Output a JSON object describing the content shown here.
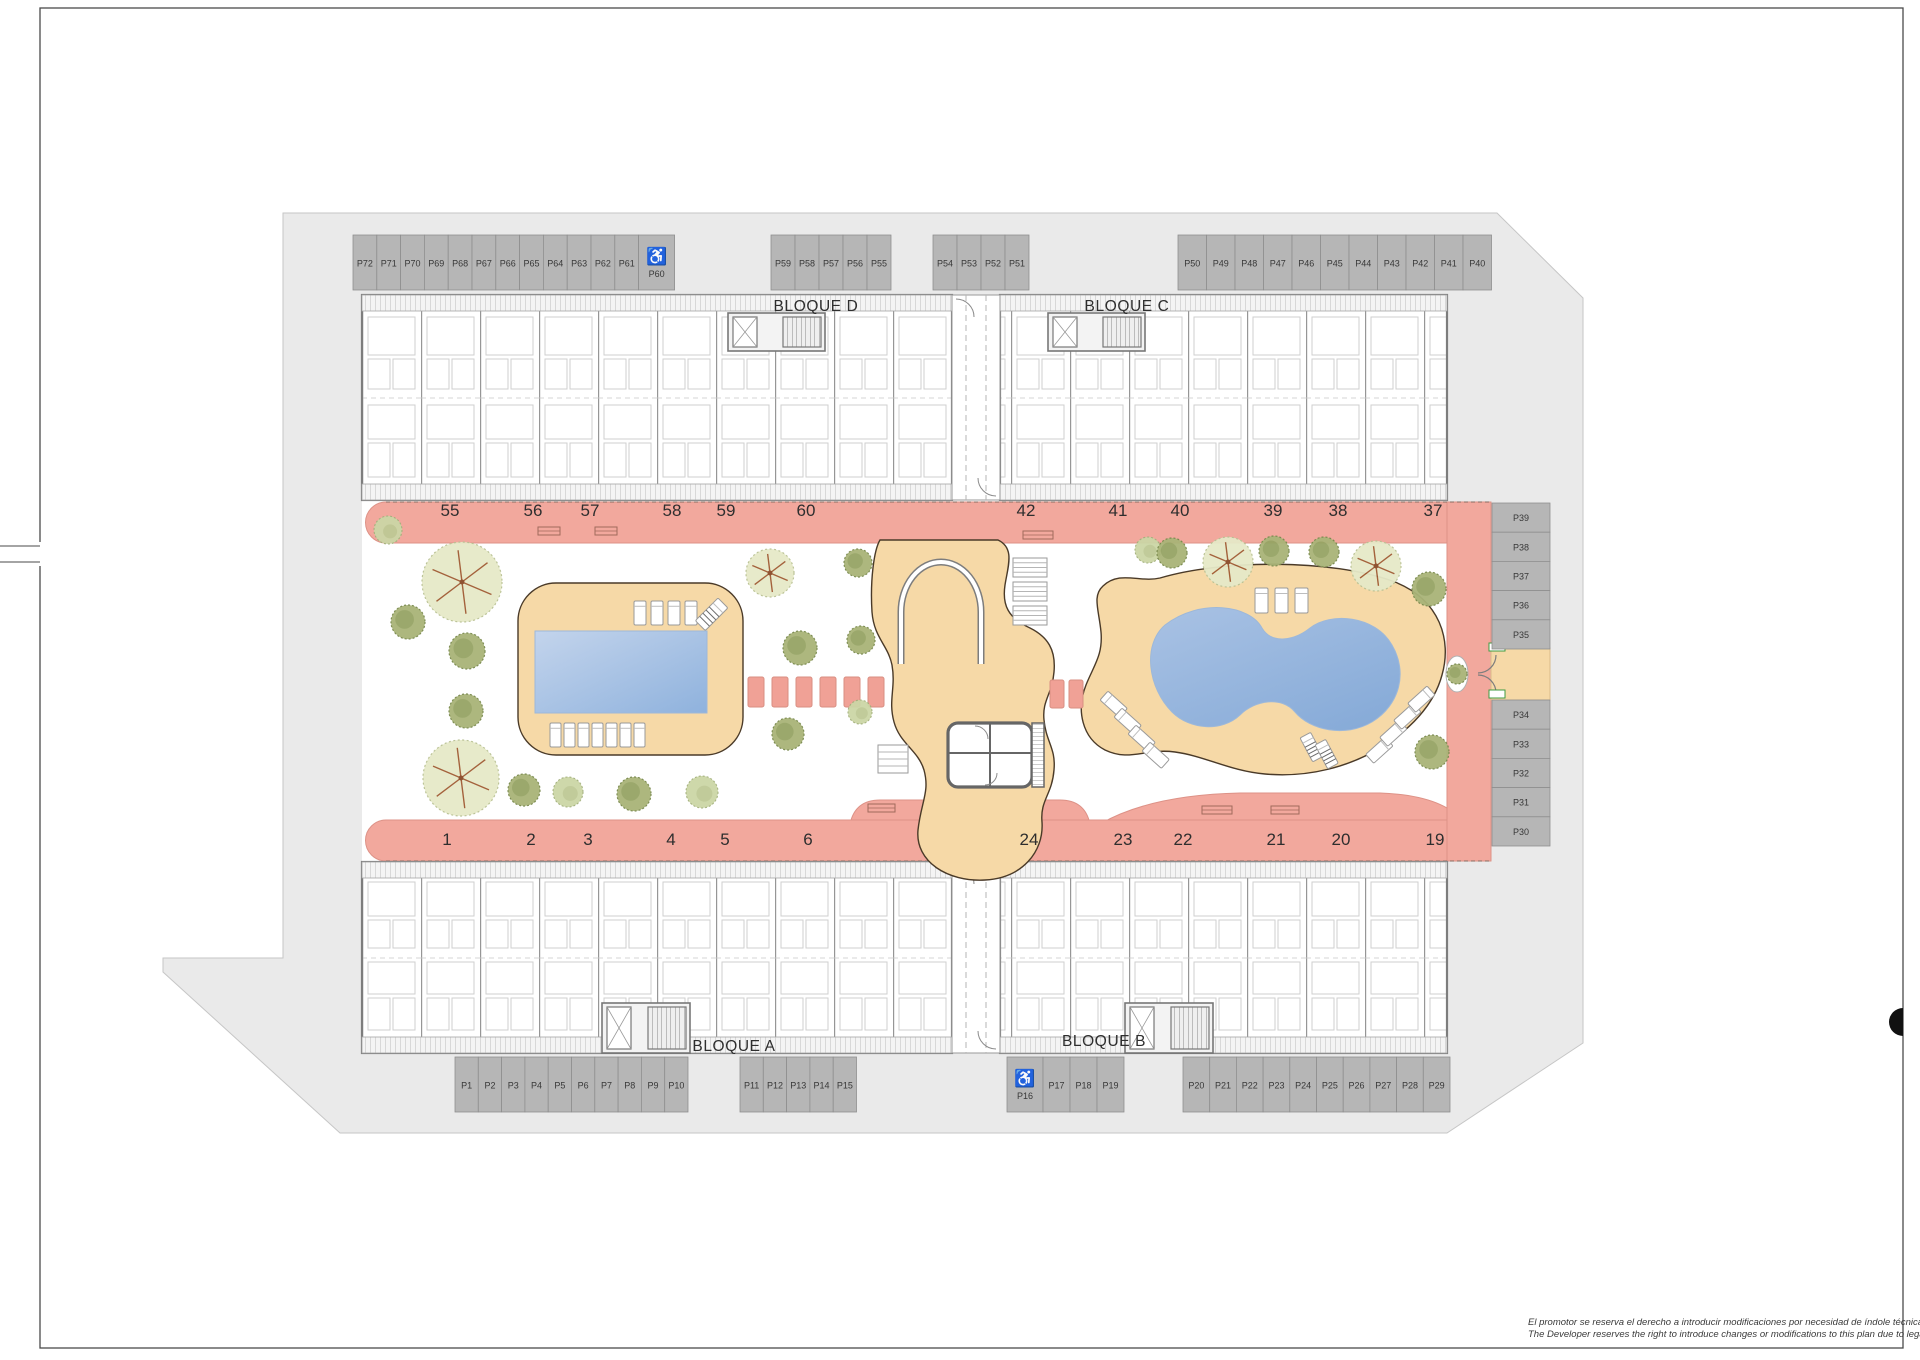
{
  "page": {
    "disclaimer_line1": "El promotor se reserva el derecho a introducir modificaciones por necesidad de índole técnica o legal.",
    "disclaimer_line2": "The Developer reserves the right to introduce changes or modifications to this plan due to legal or tech"
  },
  "colors": {
    "road": "#eaeaea",
    "stall": "#b6b6b6",
    "walkway": "#f2a89d",
    "deck": "#f6d9a7",
    "pool_light": "#bad0ea",
    "pool_dark": "#8fb2dd",
    "wall": "#7d7d7d",
    "accent_green": "#3f9b41"
  },
  "blocks": [
    {
      "label": "BLOQUE D",
      "x": 816,
      "y": 311
    },
    {
      "label": "BLOQUE C",
      "x": 1127,
      "y": 311
    },
    {
      "label": "BLOQUE A",
      "x": 734,
      "y": 1051
    },
    {
      "label": "BLOQUE B",
      "x": 1104,
      "y": 1046
    }
  ],
  "parking": {
    "groups": [
      {
        "name": "north-west",
        "dir": "h",
        "x": 353,
        "y": 235,
        "stall_w": 23.8,
        "stall_h": 55,
        "stalls": [
          "P72",
          "P71",
          "P70",
          "P69",
          "P68",
          "P67",
          "P66",
          "P65",
          "P64",
          "P63",
          "P62",
          "P61",
          {
            "label": "P60",
            "accessible": true,
            "w": 36
          }
        ]
      },
      {
        "name": "north-mid-west",
        "dir": "h",
        "x": 771,
        "y": 235,
        "stall_w": 24,
        "stall_h": 55,
        "stalls": [
          "P59",
          "P58",
          "P57",
          "P56",
          "P55"
        ]
      },
      {
        "name": "north-mid-east",
        "dir": "h",
        "x": 933,
        "y": 235,
        "stall_w": 24,
        "stall_h": 55,
        "stalls": [
          "P54",
          "P53",
          "P52",
          "P51"
        ]
      },
      {
        "name": "north-east",
        "dir": "h",
        "x": 1178,
        "y": 235,
        "stall_w": 28.5,
        "stall_h": 55,
        "stalls": [
          "P50",
          "P49",
          "P48",
          "P47",
          "P46",
          "P45",
          "P44",
          "P43",
          "P42",
          "P41",
          "P40"
        ]
      },
      {
        "name": "east-upper",
        "dir": "v",
        "x": 1492,
        "y": 503,
        "stall_w": 58,
        "stall_h": 29.2,
        "stalls": [
          "P39",
          "P38",
          "P37",
          "P36",
          "P35"
        ]
      },
      {
        "name": "east-lower",
        "dir": "v",
        "x": 1492,
        "y": 700,
        "stall_w": 58,
        "stall_h": 29.2,
        "stalls": [
          "P34",
          "P33",
          "P32",
          "P31",
          "P30"
        ]
      },
      {
        "name": "south-west",
        "dir": "h",
        "x": 455,
        "y": 1057,
        "stall_w": 23.3,
        "stall_h": 55,
        "stalls": [
          "P1",
          "P2",
          "P3",
          "P4",
          "P5",
          "P6",
          "P7",
          "P8",
          "P9",
          "P10"
        ]
      },
      {
        "name": "south-mid-west",
        "dir": "h",
        "x": 740,
        "y": 1057,
        "stall_w": 23.3,
        "stall_h": 55,
        "stalls": [
          "P11",
          "P12",
          "P13",
          "P14",
          "P15"
        ]
      },
      {
        "name": "south-mid-east",
        "dir": "h",
        "x": 1007,
        "y": 1057,
        "stall_w": 27,
        "stall_h": 55,
        "stalls": [
          {
            "label": "P16",
            "accessible": true,
            "w": 36
          },
          "P17",
          "P18",
          "P19"
        ]
      },
      {
        "name": "south-east",
        "dir": "h",
        "x": 1183,
        "y": 1057,
        "stall_w": 26.7,
        "stall_h": 55,
        "stalls": [
          "P20",
          "P21",
          "P22",
          "P23",
          "P24",
          "P25",
          "P26",
          "P27",
          "P28",
          "P29"
        ]
      }
    ]
  },
  "unit_numbers": {
    "top": {
      "y": 516,
      "items": [
        {
          "n": "55",
          "x": 450
        },
        {
          "n": "56",
          "x": 533
        },
        {
          "n": "57",
          "x": 590
        },
        {
          "n": "58",
          "x": 672
        },
        {
          "n": "59",
          "x": 726
        },
        {
          "n": "60",
          "x": 806
        },
        {
          "n": "42",
          "x": 1026
        },
        {
          "n": "41",
          "x": 1118
        },
        {
          "n": "40",
          "x": 1180
        },
        {
          "n": "39",
          "x": 1273
        },
        {
          "n": "38",
          "x": 1338
        },
        {
          "n": "37",
          "x": 1433
        }
      ]
    },
    "bottom": {
      "y": 845,
      "items": [
        {
          "n": "1",
          "x": 447
        },
        {
          "n": "2",
          "x": 531
        },
        {
          "n": "3",
          "x": 588
        },
        {
          "n": "4",
          "x": 671
        },
        {
          "n": "5",
          "x": 725
        },
        {
          "n": "6",
          "x": 808
        },
        {
          "n": "24",
          "x": 1029
        },
        {
          "n": "23",
          "x": 1123
        },
        {
          "n": "22",
          "x": 1183
        },
        {
          "n": "21",
          "x": 1276
        },
        {
          "n": "20",
          "x": 1341
        },
        {
          "n": "19",
          "x": 1435
        }
      ]
    }
  }
}
